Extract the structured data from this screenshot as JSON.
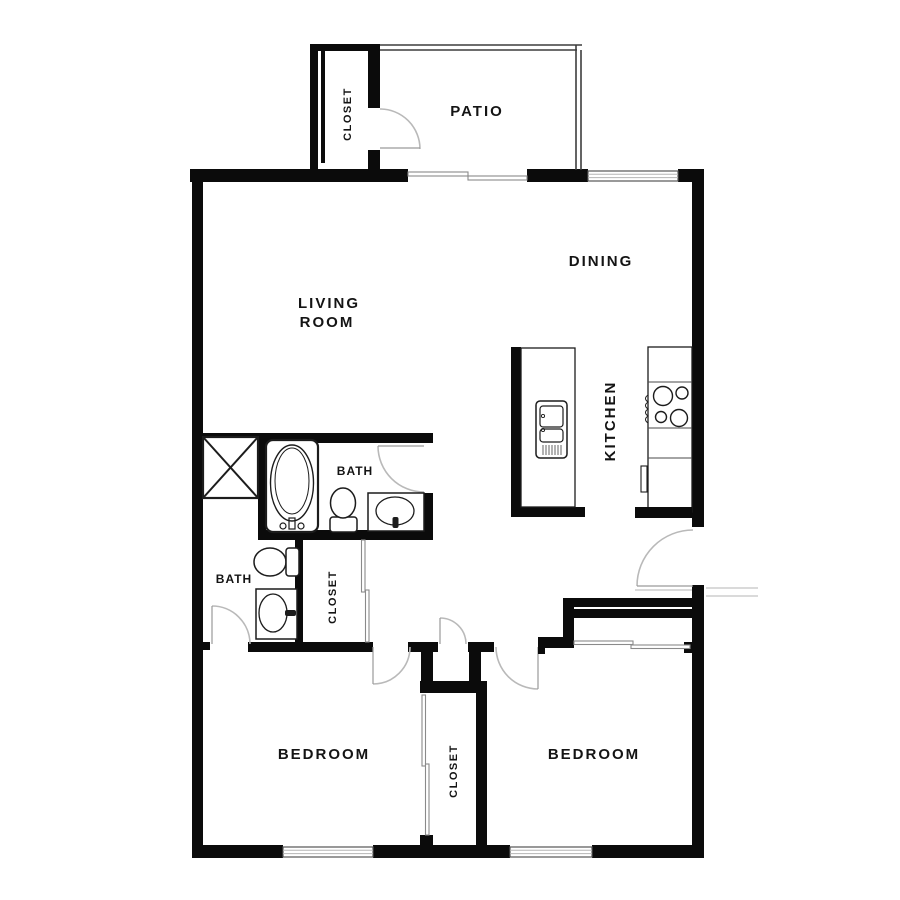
{
  "floorplan": {
    "labels": {
      "patio": "PATIO",
      "living_line1": "LIVING",
      "living_line2": "ROOM",
      "dining": "DINING",
      "kitchen": "KITCHEN",
      "bath_main": "BATH",
      "bath_second": "BATH",
      "closet_patio": "CLOSET",
      "closet_hall": "CLOSET",
      "closet_bedroom": "CLOSET",
      "bedroom_left": "BEDROOM",
      "bedroom_right": "BEDROOM"
    },
    "colors": {
      "wall": "#0b0b0b",
      "background": "#ffffff",
      "door_swing": "#b9b9b9",
      "fixture_line": "#1c1c1c"
    }
  }
}
